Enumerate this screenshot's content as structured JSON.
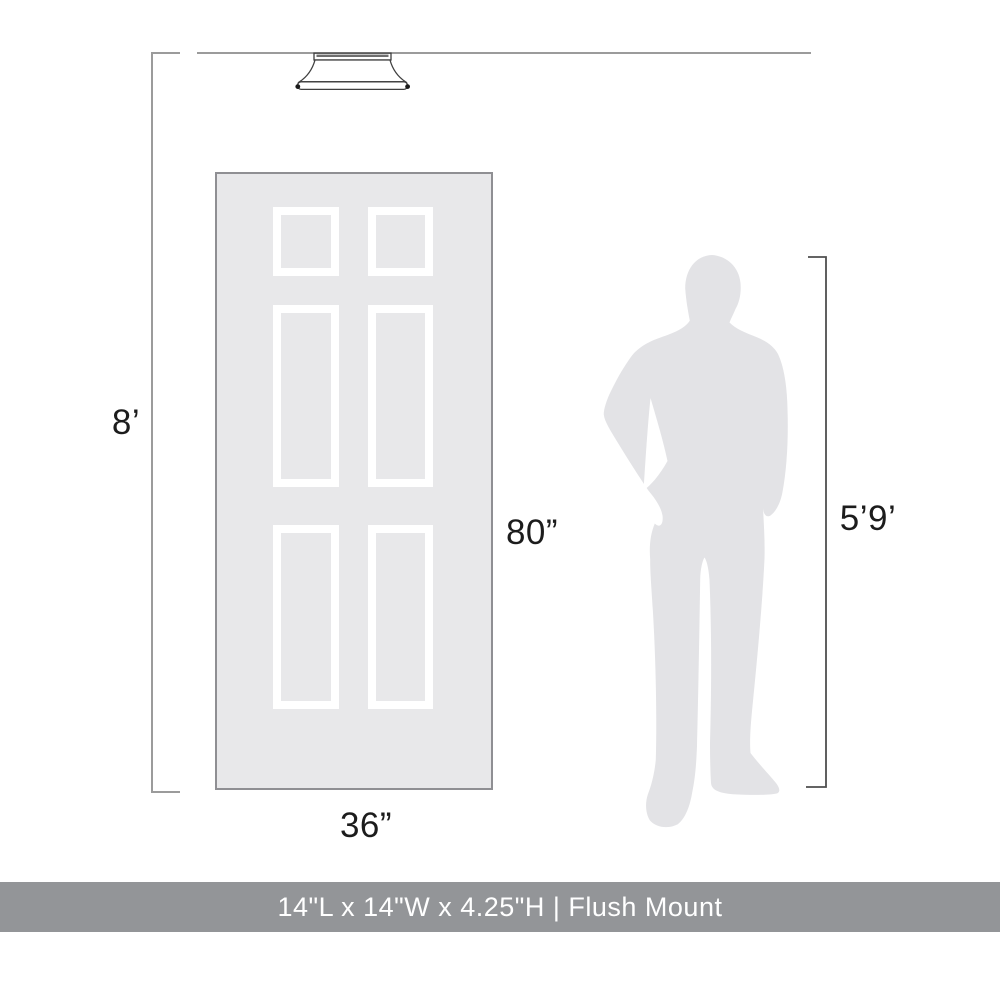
{
  "diagram": {
    "type": "product-size-comparison",
    "ceiling_height_label": "8’",
    "door_height_label": "80”",
    "door_width_label": "36”",
    "person_height_label": "5’9’",
    "door_panel_count": 6,
    "figures": {
      "fixture": "flush-mount-ceiling-light",
      "door": "six-panel-door",
      "person": "standing-man-silhouette"
    }
  },
  "banner": {
    "text": "14\"L x 14\"W x 4.25\"H | Flush Mount"
  },
  "colors": {
    "background": "#ffffff",
    "line_gray": "#9b9b9b",
    "line_dark": "#4f4f4f",
    "door_fill": "#e8e8ea",
    "door_border": "#8f8f93",
    "panel_frame": "#ffffff",
    "silhouette_fill": "#e3e3e6",
    "fixture_stroke": "#3f3f3f",
    "label_text": "#1c1c1c",
    "banner_bg": "#939598",
    "banner_text": "#ffffff"
  }
}
